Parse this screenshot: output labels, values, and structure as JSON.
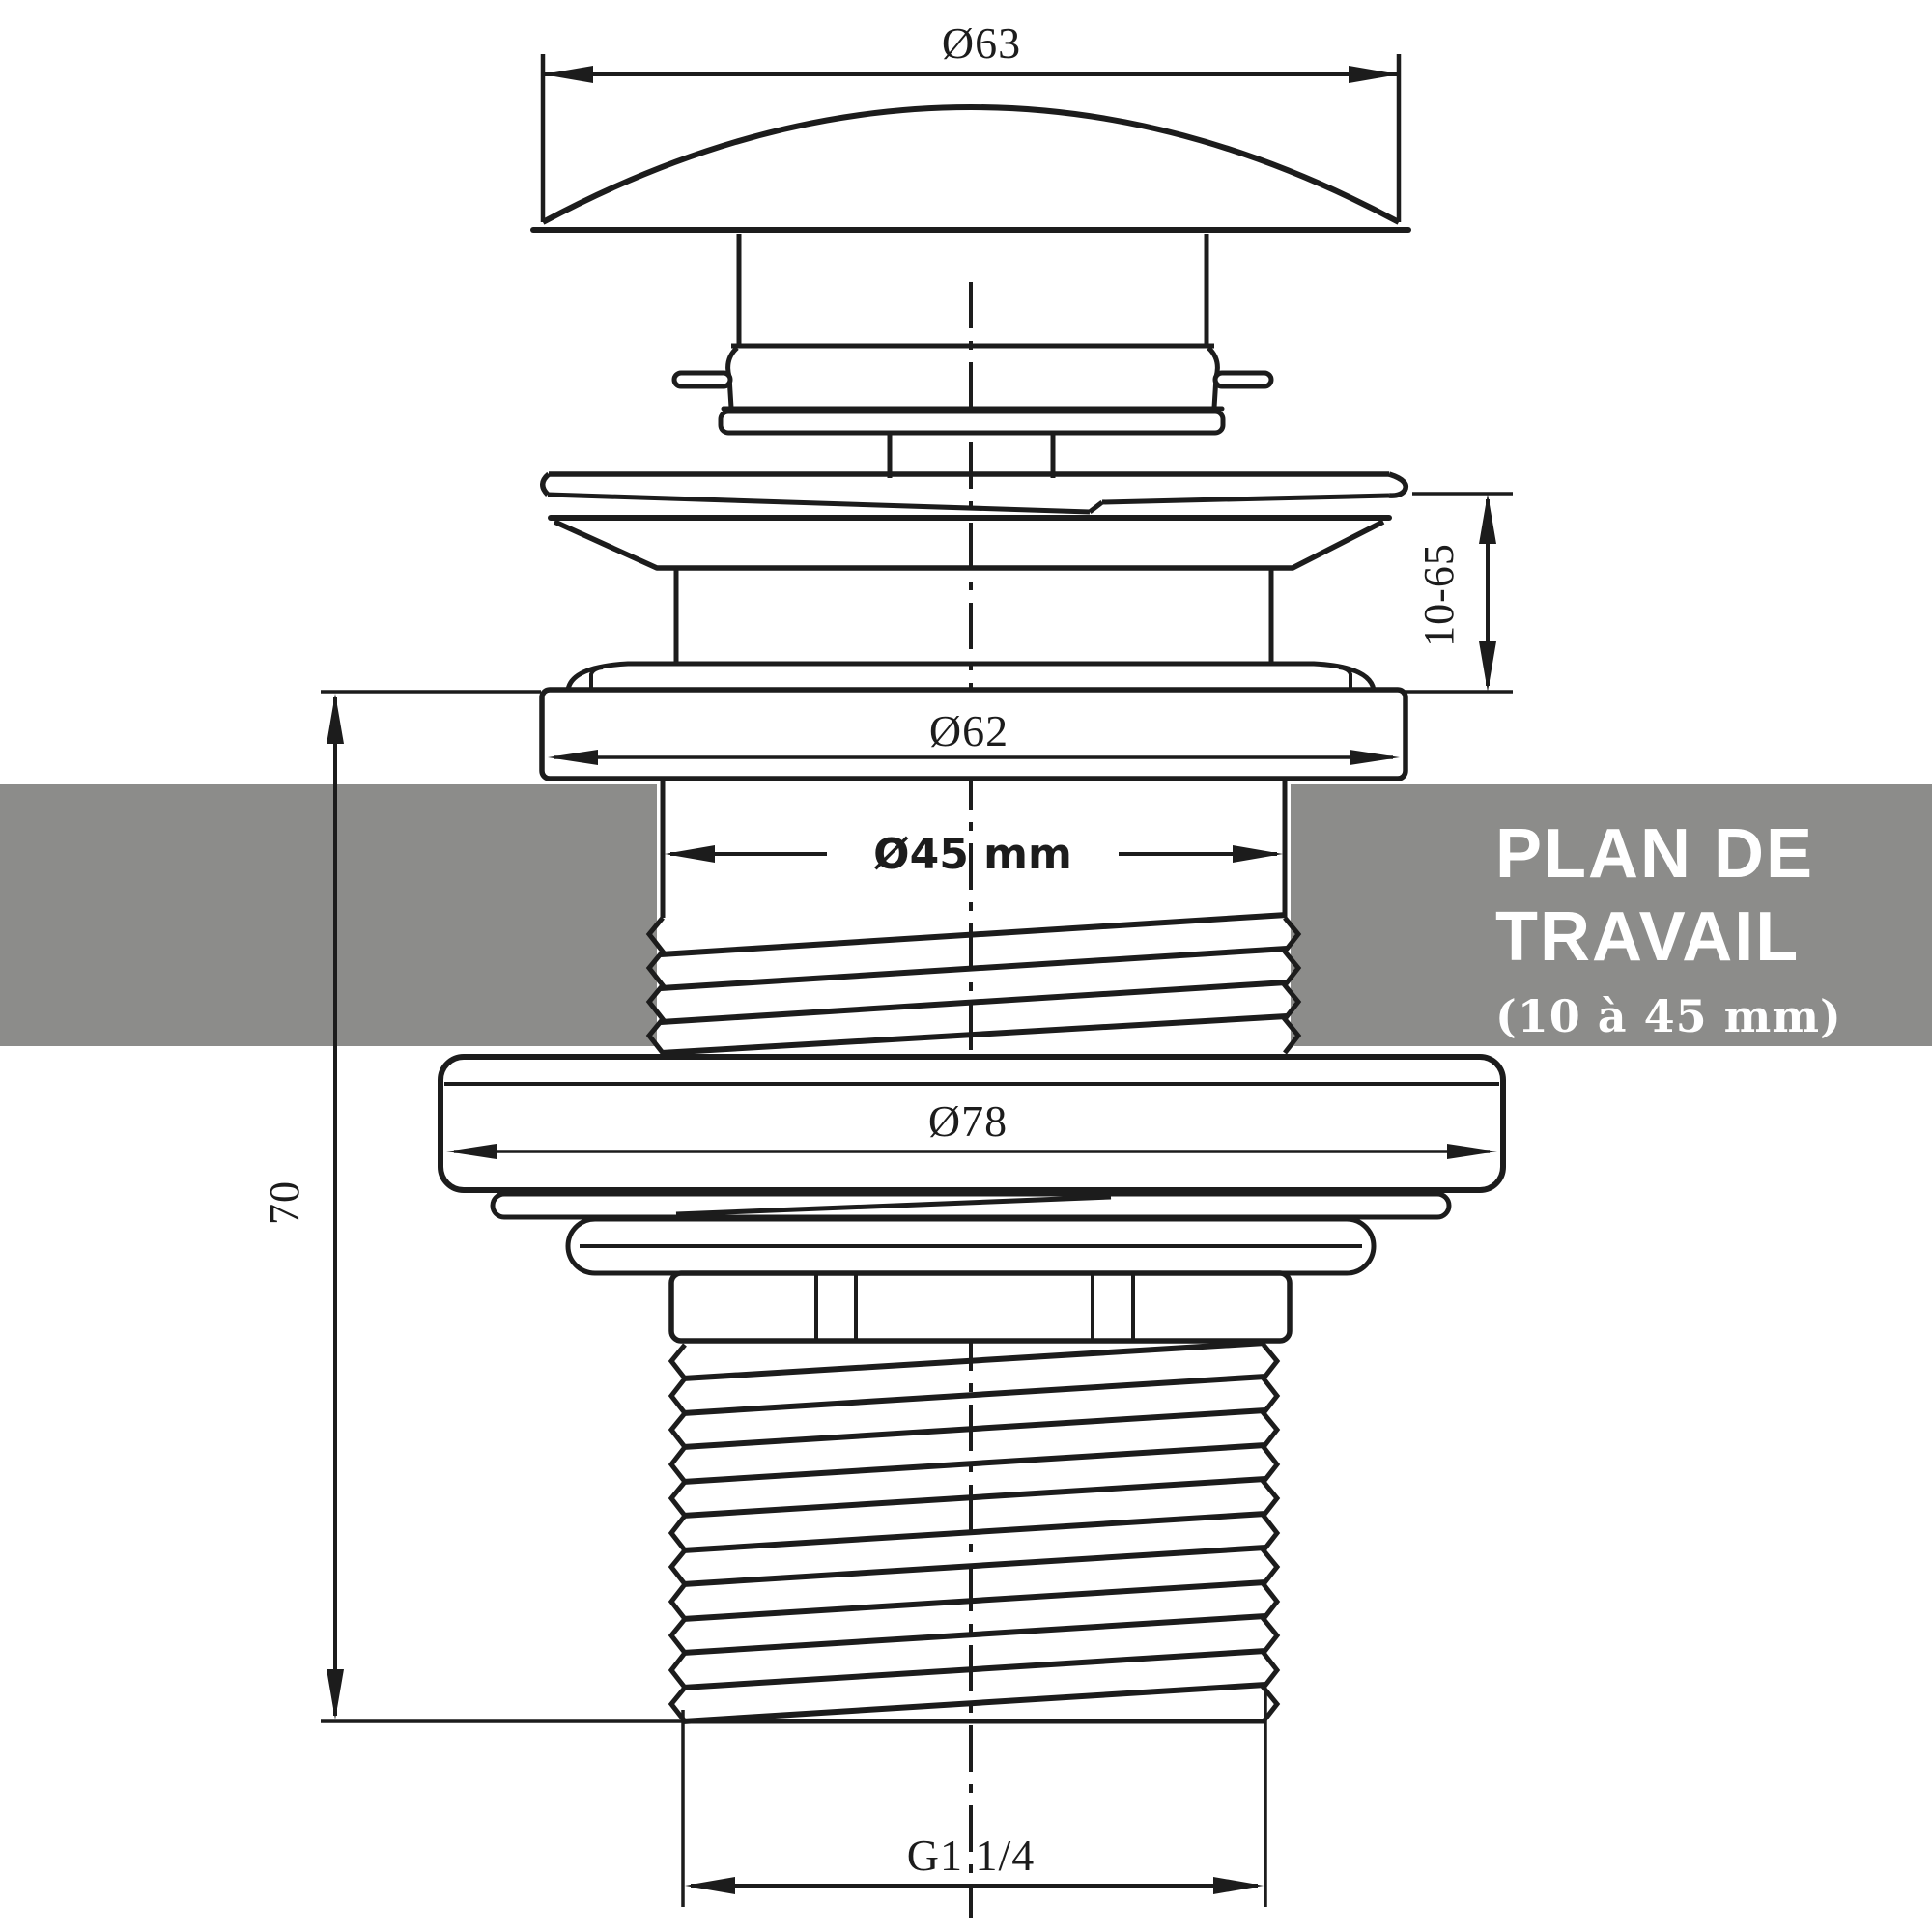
{
  "drawing": {
    "dimension_labels": {
      "cap_diameter": "Ø63",
      "plug_height_range": "10-65",
      "flange_diameter": "Ø62",
      "bore_diameter": "Ø45 mm",
      "nut_diameter": "Ø78",
      "body_height": "70",
      "thread_size": "G1 1/4"
    },
    "work_surface_band": {
      "line1": "PLAN DE",
      "line2": "TRAVAIL",
      "line3": "(10 à 45 mm)"
    },
    "colors": {
      "line": "#1c1c1c",
      "work_surface": "#8c8c8a",
      "band_text": "#ffffff",
      "background": "#ffffff"
    }
  }
}
